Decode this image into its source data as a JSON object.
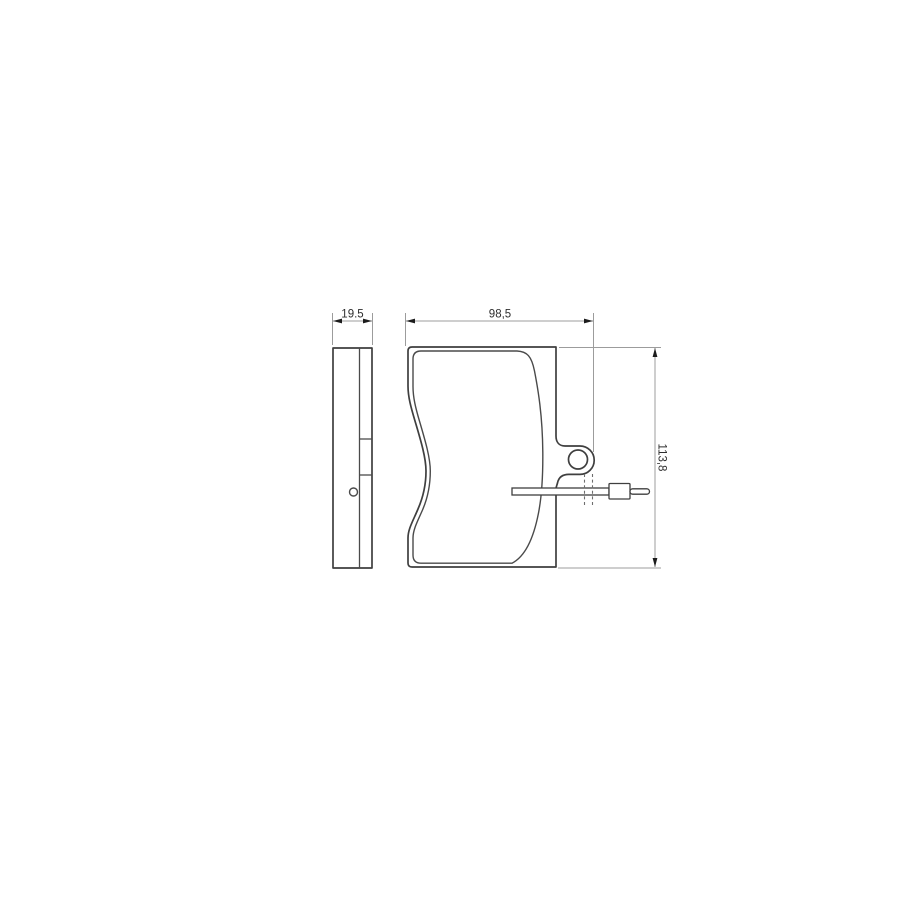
{
  "drawing": {
    "title": "brake-pad-technical-drawing",
    "description": "Two-view dimensioned line drawing of a disc brake pad with acoustic wear indicator wire",
    "line_color": "#3f3f3f",
    "dimension_line_color": "#9c9c9c",
    "text_color": "#2e2e2e",
    "background_color": "#ffffff",
    "views": {
      "side_view": "pad thickness profile with sensor hole",
      "front_view": "backing plate with friction material, mounting ear with hole, wear indicator wire"
    },
    "dimensions": {
      "side_width": {
        "label": "19.5",
        "value": 19.5
      },
      "front_width": {
        "label": "98,5",
        "value": 98.5
      },
      "front_height": {
        "label": "113,8",
        "value": 113.8
      }
    }
  }
}
